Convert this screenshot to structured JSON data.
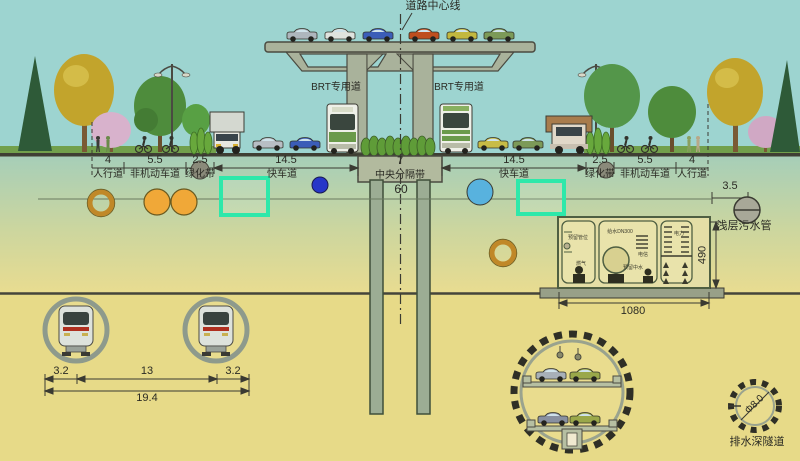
{
  "labels": {
    "centerline": "道路中心线",
    "brt_left": "BRT专用道",
    "brt_right": "BRT专用道",
    "total_width": "60",
    "sewer_offset": "3.5",
    "sewer_pipe": "浅层污水管",
    "deep_tunnel_diameter": "Φ8.0",
    "deep_tunnel": "排水深隧道"
  },
  "road_segments": [
    {
      "width": "4",
      "name": "人行道"
    },
    {
      "width": "5.5",
      "name": "非机动车道"
    },
    {
      "width": "2.5",
      "name": "绿化带"
    },
    {
      "width": "14.5",
      "name": "快车道"
    },
    {
      "width": "7",
      "name": "中央分隔带"
    },
    {
      "width": "14.5",
      "name": "快车道"
    },
    {
      "width": "2.5",
      "name": "绿化带"
    },
    {
      "width": "5.5",
      "name": "非机动车道"
    },
    {
      "width": "4",
      "name": "人行道"
    }
  ],
  "utility_corridor": {
    "width": "1080",
    "height": "490",
    "compartments": [
      {
        "labels": [
          "预留管位",
          "燃气"
        ]
      },
      {
        "labels": [
          "给水DN300",
          "电信",
          "预留中水"
        ]
      },
      {
        "labels": [
          "电力"
        ]
      }
    ]
  },
  "metro_tunnels": {
    "left_margin": "3.2",
    "spacing": "13",
    "right_margin": "3.2",
    "total": "19.4"
  },
  "colors": {
    "sky": "#9dd4d0",
    "soil": "#e7da88",
    "highlight_box": "#2ee8aa",
    "heat_pipe_orange": "#f0a838",
    "water_pipe_blue": "#2636c8",
    "rain_pipe_blue": "#58b2de"
  }
}
